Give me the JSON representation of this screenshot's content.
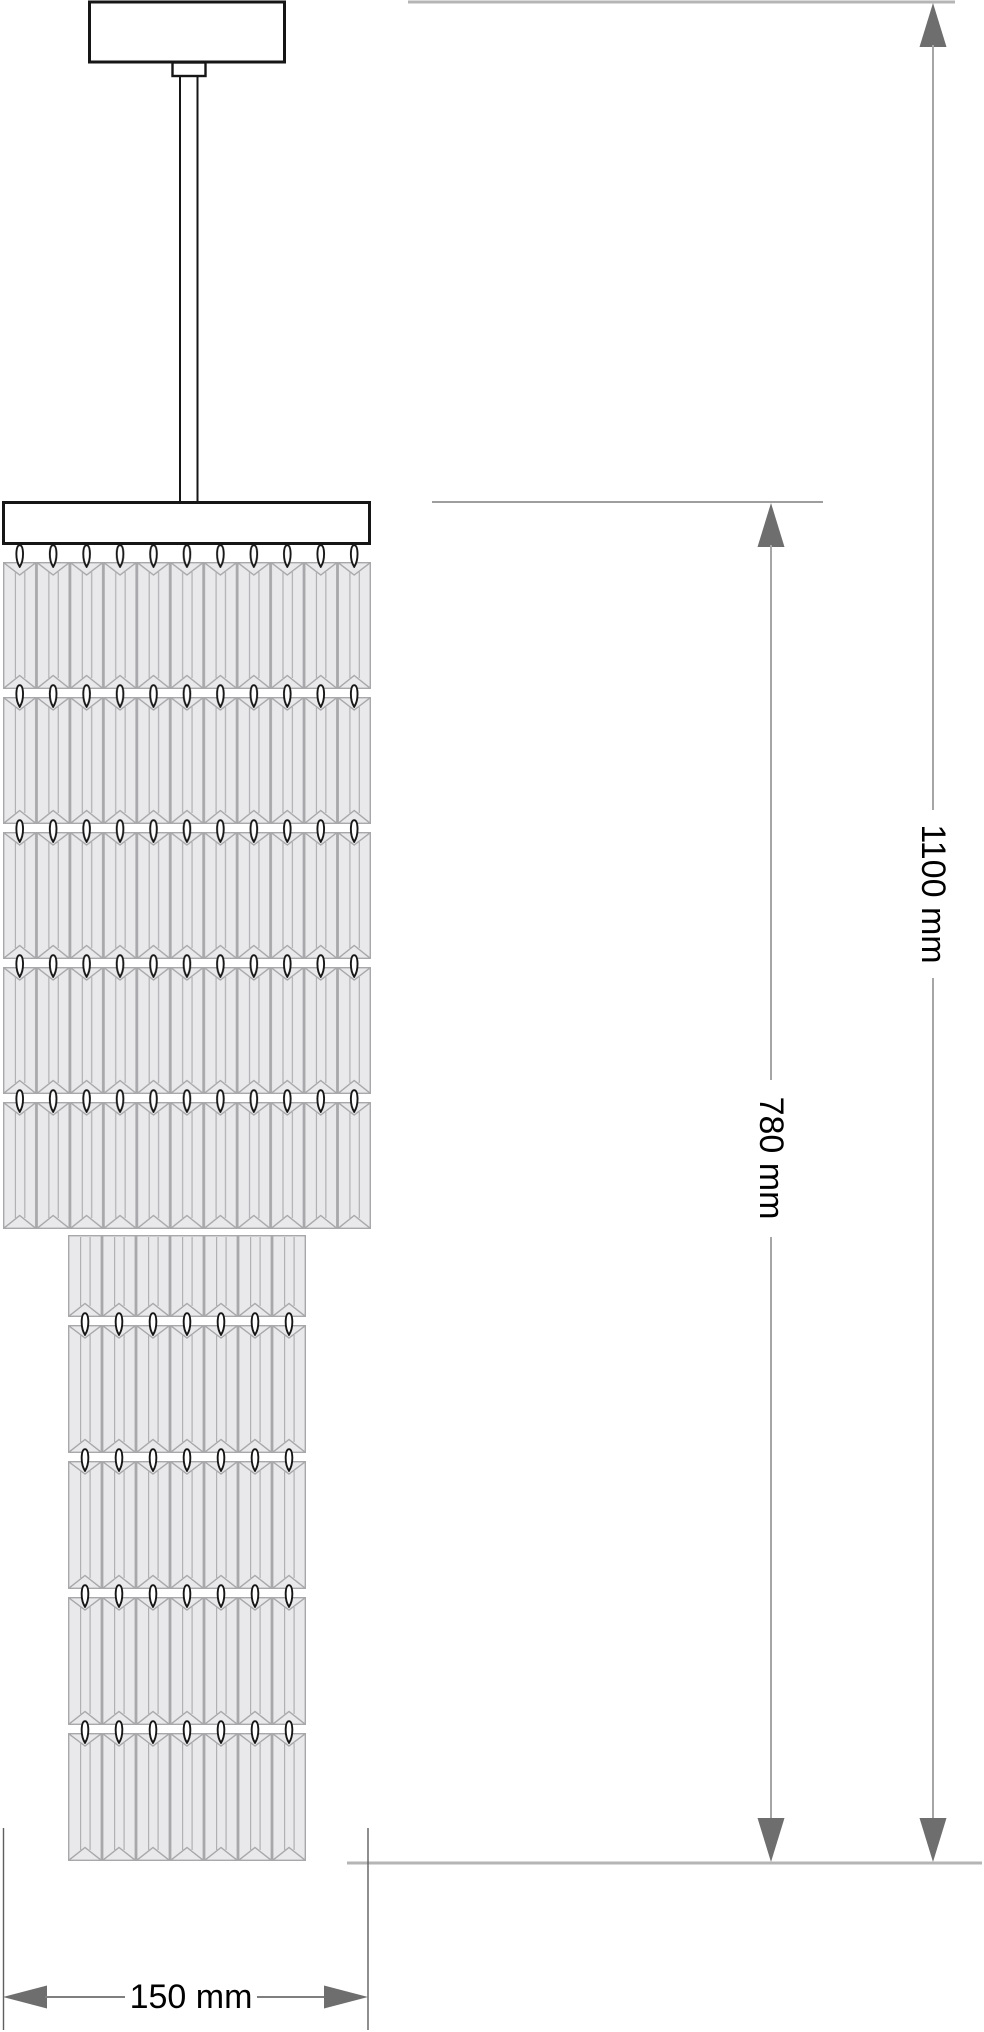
{
  "drawing": {
    "subject": "Crystal pendant light - front elevation dimension drawing",
    "labels": {
      "overall_height": "1100 mm",
      "crystal_height": "780 mm",
      "width": "150 mm"
    },
    "structure": {
      "upper_tier": {
        "rows": 5,
        "columns": 11
      },
      "lower_tier": {
        "rows": 5,
        "columns": 7
      },
      "parts": [
        "ceiling-canopy",
        "suspension-rod",
        "rod-collar",
        "crystal-frame-plate",
        "crystal-rows",
        "hook-rows"
      ]
    },
    "colors": {
      "background": "#ffffff",
      "outline": "#161616",
      "crystal_fill": "#e9e9eb",
      "crystal_line": "#a8a8ab",
      "dimension_line": "#a6a6a6",
      "extension_line": "#b5b5b5",
      "arrow": "#6e6e6e",
      "label_text": "#000000"
    }
  }
}
